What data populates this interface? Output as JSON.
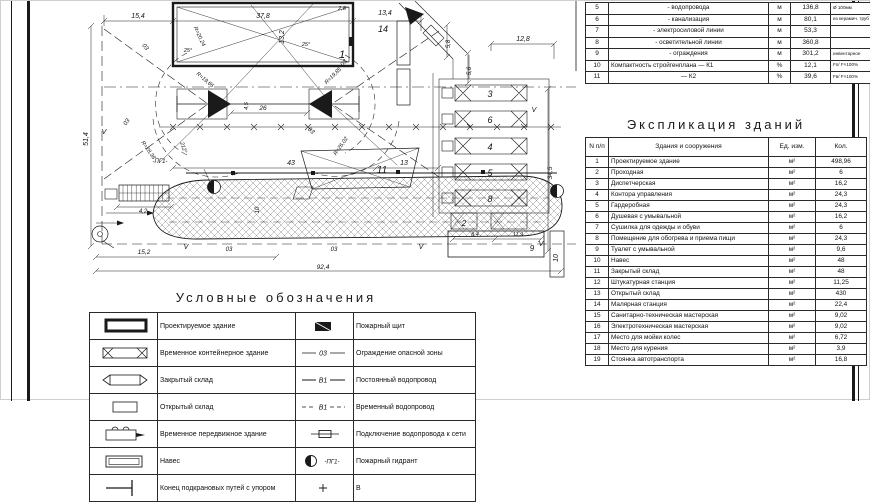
{
  "top_table": {
    "rows": [
      {
        "num": "5",
        "name": "- водопровода",
        "unit": "м",
        "qty": "136,8",
        "note": "Ø 100мм"
      },
      {
        "num": "6",
        "name": "- канализация",
        "unit": "м",
        "qty": "80,1",
        "note": "из керамич. труб"
      },
      {
        "num": "7",
        "name": "- электросиловой линии",
        "unit": "м",
        "qty": "53,3",
        "note": ""
      },
      {
        "num": "8",
        "name": "- осветительной линии",
        "unit": "м",
        "qty": "360,8",
        "note": ""
      },
      {
        "num": "9",
        "name": "- ограждения",
        "unit": "м",
        "qty": "301,2",
        "note": "инвентарное"
      },
      {
        "num": "10",
        "name": "Компактность стройгенплана — К1",
        "unit": "%",
        "qty": "12,1",
        "note": "Fп/ F×100%"
      },
      {
        "num": "11",
        "name": "— К2",
        "unit": "%",
        "qty": "39,6",
        "note": "Fв/ F×100%"
      }
    ]
  },
  "explication": {
    "title": "Экспликация зданий",
    "headers": {
      "num": "N п/п",
      "name": "Здания и сооружения",
      "unit": "Ед. изм.",
      "qty": "Кол."
    },
    "rows": [
      {
        "num": "1",
        "name": "Проектируемое здание",
        "unit": "м²",
        "qty": "498,96"
      },
      {
        "num": "2",
        "name": "Проходная",
        "unit": "м²",
        "qty": "6"
      },
      {
        "num": "3",
        "name": "Диспетчерская",
        "unit": "м²",
        "qty": "16,2"
      },
      {
        "num": "4",
        "name": "Контора управления",
        "unit": "м²",
        "qty": "24,3"
      },
      {
        "num": "5",
        "name": "Гардеробная",
        "unit": "м²",
        "qty": "24,3"
      },
      {
        "num": "6",
        "name": "Душевая с умывальной",
        "unit": "м²",
        "qty": "16,2"
      },
      {
        "num": "7",
        "name": "Сушилка для одежды и обуви",
        "unit": "м²",
        "qty": "6"
      },
      {
        "num": "8",
        "name": "Помещение для обогрева и приема пищи",
        "unit": "м²",
        "qty": "24,3"
      },
      {
        "num": "9",
        "name": "Туалет с умывальной",
        "unit": "м²",
        "qty": "9,6"
      },
      {
        "num": "10",
        "name": "Навес",
        "unit": "м²",
        "qty": "48"
      },
      {
        "num": "11",
        "name": "Закрытый склад",
        "unit": "м²",
        "qty": "48"
      },
      {
        "num": "12",
        "name": "Штукатурная станция",
        "unit": "м²",
        "qty": "11,25"
      },
      {
        "num": "13",
        "name": "Открытый склад",
        "unit": "м²",
        "qty": "430"
      },
      {
        "num": "14",
        "name": "Малярная станция",
        "unit": "м²",
        "qty": "22,4"
      },
      {
        "num": "15",
        "name": "Санитарно-техническая мастерская",
        "unit": "м²",
        "qty": "9,02"
      },
      {
        "num": "16",
        "name": "Электротехническая мастерская",
        "unit": "м²",
        "qty": "9,02"
      },
      {
        "num": "17",
        "name": "Место для мойки колес",
        "unit": "м²",
        "qty": "6,72"
      },
      {
        "num": "18",
        "name": "Место для курения",
        "unit": "м²",
        "qty": "3,9"
      },
      {
        "num": "19",
        "name": "Стоянка автотранспорта",
        "unit": "м²",
        "qty": "16,8"
      }
    ]
  },
  "legend": {
    "title": "Условные обозначения",
    "rows": [
      {
        "s1": "projected-building-symbol",
        "l1": "Проектируемое здание",
        "s2": "fire-shield-symbol",
        "st2": "",
        "l2": "Пожарный щит"
      },
      {
        "s1": "temp-container-building-symbol",
        "l1": "Временное контейнерное здание",
        "s2": "danger-zone-line-symbol",
        "st2": "03",
        "l2": "Ограждение опасной зоны"
      },
      {
        "s1": "closed-warehouse-symbol",
        "l1": "Закрытый склад",
        "s2": "permanent-water-line-symbol",
        "st2": "В1",
        "l2": "Постоянный водопровод"
      },
      {
        "s1": "open-warehouse-symbol",
        "l1": "Открытый склад",
        "s2": "temp-water-line-symbol",
        "st2": "В1",
        "l2": "Временный водопровод"
      },
      {
        "s1": "mobile-building-symbol",
        "l1": "Временное передвижное здание",
        "s2": "water-connection-symbol",
        "st2": "",
        "l2": "Подключение водопровода к сети"
      },
      {
        "s1": "shed-symbol",
        "l1": "Навес",
        "s2": "hydrant-symbol",
        "st2": "-ПГ1-",
        "l2": "Пожарный гидрант"
      },
      {
        "s1": "crane-rail-end-symbol",
        "l1": "Конец подкрановых путей с упором",
        "s2": "plus-symbol",
        "st2": "",
        "l2": "В"
      }
    ]
  },
  "plan": {
    "labels": [
      {
        "t": "15,4",
        "x": 137,
        "y": 17
      },
      {
        "t": "37,8",
        "x": 262,
        "y": 17
      },
      {
        "t": "2,8",
        "x": 341,
        "y": 9,
        "s": 5.5
      },
      {
        "t": "13,4",
        "x": 384,
        "y": 14
      },
      {
        "t": "13,2",
        "x": 283,
        "y": 36,
        "r": -90
      },
      {
        "t": "51,4",
        "x": 87,
        "y": 138,
        "r": -90
      },
      {
        "t": "1",
        "x": 341,
        "y": 57,
        "s": 11
      },
      {
        "t": "14",
        "x": 382,
        "y": 31,
        "s": 9
      },
      {
        "t": "R=20,24",
        "x": 197,
        "y": 36,
        "r": 65,
        "s": 5.5
      },
      {
        "t": "25°",
        "x": 187,
        "y": 51,
        "s": 5.5
      },
      {
        "t": "25°",
        "x": 305,
        "y": 45,
        "s": 5.5
      },
      {
        "t": "R=19,65",
        "x": 203,
        "y": 80,
        "r": 40,
        "s": 5.5
      },
      {
        "t": "R=19,85",
        "x": 333,
        "y": 76,
        "r": -45,
        "s": 5.5
      },
      {
        "t": "03",
        "x": 143,
        "y": 47,
        "r": 50,
        "s": 6
      },
      {
        "t": "03",
        "x": 127,
        "y": 122,
        "r": -55,
        "s": 6
      },
      {
        "t": "03",
        "x": 344,
        "y": 63,
        "r": -48,
        "s": 6
      },
      {
        "t": "03",
        "x": 309,
        "y": 131,
        "r": 42,
        "s": 6
      },
      {
        "t": "26",
        "x": 262,
        "y": 109,
        "s": 6.5
      },
      {
        "t": "4,5",
        "x": 247,
        "y": 105,
        "r": -90,
        "s": 5.5
      },
      {
        "t": "R=28,38",
        "x": 146,
        "y": 150,
        "r": 55,
        "s": 5.5
      },
      {
        "t": "212°",
        "x": 181,
        "y": 147,
        "r": 72,
        "s": 5.5
      },
      {
        "t": "R=26,02",
        "x": 341,
        "y": 146,
        "r": -55,
        "s": 5.5
      },
      {
        "t": "43",
        "x": 290,
        "y": 164,
        "s": 7
      },
      {
        "t": "13",
        "x": 403,
        "y": 164,
        "s": 7
      },
      {
        "t": "10",
        "x": 258,
        "y": 209,
        "r": -90,
        "s": 6
      },
      {
        "t": "-ПГ1-",
        "x": 159,
        "y": 162,
        "s": 6
      },
      {
        "t": "4,2",
        "x": 142,
        "y": 212,
        "s": 6
      },
      {
        "t": "15,2",
        "x": 143,
        "y": 253,
        "s": 6.5
      },
      {
        "t": "92,4",
        "x": 322,
        "y": 268,
        "s": 6.5
      },
      {
        "t": "12,8",
        "x": 522,
        "y": 40,
        "s": 7
      },
      {
        "t": "5,8",
        "x": 449,
        "y": 43,
        "r": -90,
        "s": 6
      },
      {
        "t": "5,6",
        "x": 470,
        "y": 70,
        "r": -90,
        "s": 6
      },
      {
        "t": "34,5",
        "x": 551,
        "y": 172,
        "r": -90,
        "s": 6.5
      },
      {
        "t": "3",
        "x": 489,
        "y": 96,
        "s": 9
      },
      {
        "t": "6",
        "x": 489,
        "y": 122,
        "s": 9
      },
      {
        "t": "4",
        "x": 489,
        "y": 149,
        "s": 9
      },
      {
        "t": "5",
        "x": 489,
        "y": 175,
        "s": 9
      },
      {
        "t": "8",
        "x": 489,
        "y": 201,
        "s": 9
      },
      {
        "t": "2",
        "x": 463,
        "y": 225,
        "s": 8
      },
      {
        "t": "11",
        "x": 381,
        "y": 172,
        "s": 10
      },
      {
        "t": "9",
        "x": 531,
        "y": 250,
        "s": 8
      },
      {
        "t": "8,4",
        "x": 474,
        "y": 235,
        "s": 5.5
      },
      {
        "t": "11,9",
        "x": 517,
        "y": 235,
        "s": 5.5
      },
      {
        "t": "10",
        "x": 557,
        "y": 257,
        "r": -90,
        "s": 7
      },
      {
        "t": "03",
        "x": 228,
        "y": 250,
        "s": 6
      },
      {
        "t": "03",
        "x": 333,
        "y": 250,
        "s": 6
      },
      {
        "t": "V",
        "x": 103,
        "y": 133,
        "s": 7
      },
      {
        "t": "V",
        "x": 185,
        "y": 248,
        "s": 7
      },
      {
        "t": "V",
        "x": 420,
        "y": 248,
        "s": 7
      },
      {
        "t": "V",
        "x": 533,
        "y": 111,
        "s": 7
      },
      {
        "t": "V",
        "x": 540,
        "y": 245,
        "s": 7
      }
    ]
  }
}
